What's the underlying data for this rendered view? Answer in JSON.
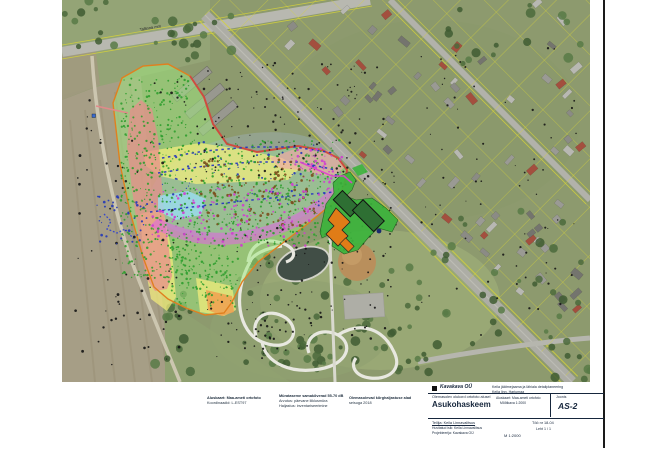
{
  "sheet": {
    "road_label": "Tallinna mnt",
    "notes": [
      {
        "lines": [
          "Aluskaart: Maa-ameti ortofoto",
          "Koordinaadid: L-EST97"
        ]
      },
      {
        "lines": [
          "Mürataseme samakõverad 55-70 dB",
          "Arvutus: päevane liiklusmüra",
          "Haljastus: inventariseerimine"
        ]
      },
      {
        "lines": [
          "Olemasolevad kõrghaljastuse alad",
          "seisuga 2018"
        ]
      }
    ],
    "title_block": {
      "firm": "Kavakava OÜ",
      "project": "Keila jäätmejaama ja lähiala detailplaneering",
      "location": "Keila linn, Harjumaa",
      "drawing_note": "Olemasolev olukord ortofoto alusel",
      "title": "Asukohaskeem",
      "extra1": "Aluskaart: Maa-ameti ortofoto",
      "extra2": "Mõõtkava 1:2000",
      "sheet_label": "Joonis",
      "sheet_no": "AS-2",
      "client": "Tellija: Keila Linnavalitsus",
      "row3a": "Huvitatud isik: Keila Linnavalitsus",
      "row3b": "Projekteerija: Kavakava OÜ",
      "scale": "M 1:2000",
      "work_no": "Töö nr 18-04",
      "sheet_count": "Leht 1 / 1"
    },
    "colors": {
      "zone_green": "#9fe87f",
      "zone_red": "#e98c8c",
      "zone_yellow": "#f6ef7c",
      "zone_pink": "#f2a8a8",
      "zone_magenta": "#de6ade",
      "zone_cyan": "#98ddf2",
      "zone_greyblue": "#a0b6cc",
      "boundary_orange": "#e0801f",
      "site_green": "#3cb43c",
      "building_orange": "#e07c17",
      "building_dark": "#2e6f33",
      "cadastral_yellow": "#d6d33a"
    },
    "decor": {
      "dot_zones": [
        [
          120,
          78,
          72,
          200,
          420,
          "#2f9e2f",
          0.85
        ],
        [
          190,
          140,
          150,
          105,
          430,
          "#2f9e2f",
          0.85
        ],
        [
          168,
          245,
          70,
          62,
          150,
          "#2f9e2f",
          0.85
        ],
        [
          200,
          158,
          115,
          68,
          120,
          "#7a4f1d",
          1.05
        ],
        [
          152,
          188,
          185,
          58,
          150,
          "#cf3fcf",
          0.95
        ],
        [
          288,
          146,
          55,
          40,
          45,
          "#cf3fcf",
          0.95
        ],
        [
          72,
          75,
          115,
          290,
          80,
          "#151515",
          0.95
        ],
        [
          195,
          62,
          190,
          115,
          110,
          "#151515",
          0.85
        ],
        [
          235,
          225,
          160,
          115,
          80,
          "#151515",
          0.85
        ],
        [
          415,
          45,
          165,
          290,
          70,
          "#151515",
          0.8
        ],
        [
          330,
          168,
          68,
          85,
          45,
          "#151515",
          0.85
        ],
        [
          152,
          142,
          185,
          65,
          60,
          "#2438b8",
          0.9
        ],
        [
          96,
          196,
          52,
          48,
          40,
          "#2438b8",
          0.95
        ],
        [
          205,
          300,
          110,
          60,
          40,
          "#151515",
          0.8
        ]
      ],
      "dash_rows": [
        {
          "points": [
            [
              162,
              158
            ],
            [
              205,
              151
            ],
            [
              250,
              147
            ],
            [
              295,
              147
            ],
            [
              333,
              153
            ]
          ],
          "color": "#2838c0",
          "width": 1.5,
          "dash": "2.5,3.5"
        },
        {
          "points": [
            [
              158,
              173
            ],
            [
              205,
              166
            ],
            [
              252,
              162
            ],
            [
              298,
              162
            ],
            [
              336,
              170
            ]
          ],
          "color": "#2838c0",
          "width": 1.5,
          "dash": "2.5,3.5"
        },
        {
          "points": [
            [
              150,
              212
            ],
            [
              200,
              206
            ],
            [
              252,
              200
            ],
            [
              300,
              195
            ],
            [
              334,
              192
            ]
          ],
          "color": "#2838c0",
          "width": 1.5,
          "dash": "2.5,3.5"
        },
        {
          "points": [
            [
              104,
              214
            ],
            [
              111,
              221
            ],
            [
              107,
              229
            ],
            [
              117,
              233
            ],
            [
              125,
              229
            ],
            [
              132,
              237
            ],
            [
              140,
              234
            ]
          ],
          "color": "#3344cc",
          "width": 1.3,
          "dash": "1.8,1.8"
        }
      ],
      "tree_zones": [
        [
          240,
          250,
          195,
          128,
          55
        ],
        [
          432,
          195,
          150,
          150,
          28
        ],
        [
          300,
          300,
          125,
          80,
          22
        ],
        [
          140,
          14,
          95,
          46,
          18
        ],
        [
          62,
          0,
          55,
          48,
          10
        ],
        [
          545,
          300,
          45,
          80,
          10
        ],
        [
          150,
          288,
          52,
          92,
          14
        ],
        [
          448,
          0,
          140,
          70,
          16
        ]
      ],
      "houses": {
        "count": 72
      }
    }
  }
}
